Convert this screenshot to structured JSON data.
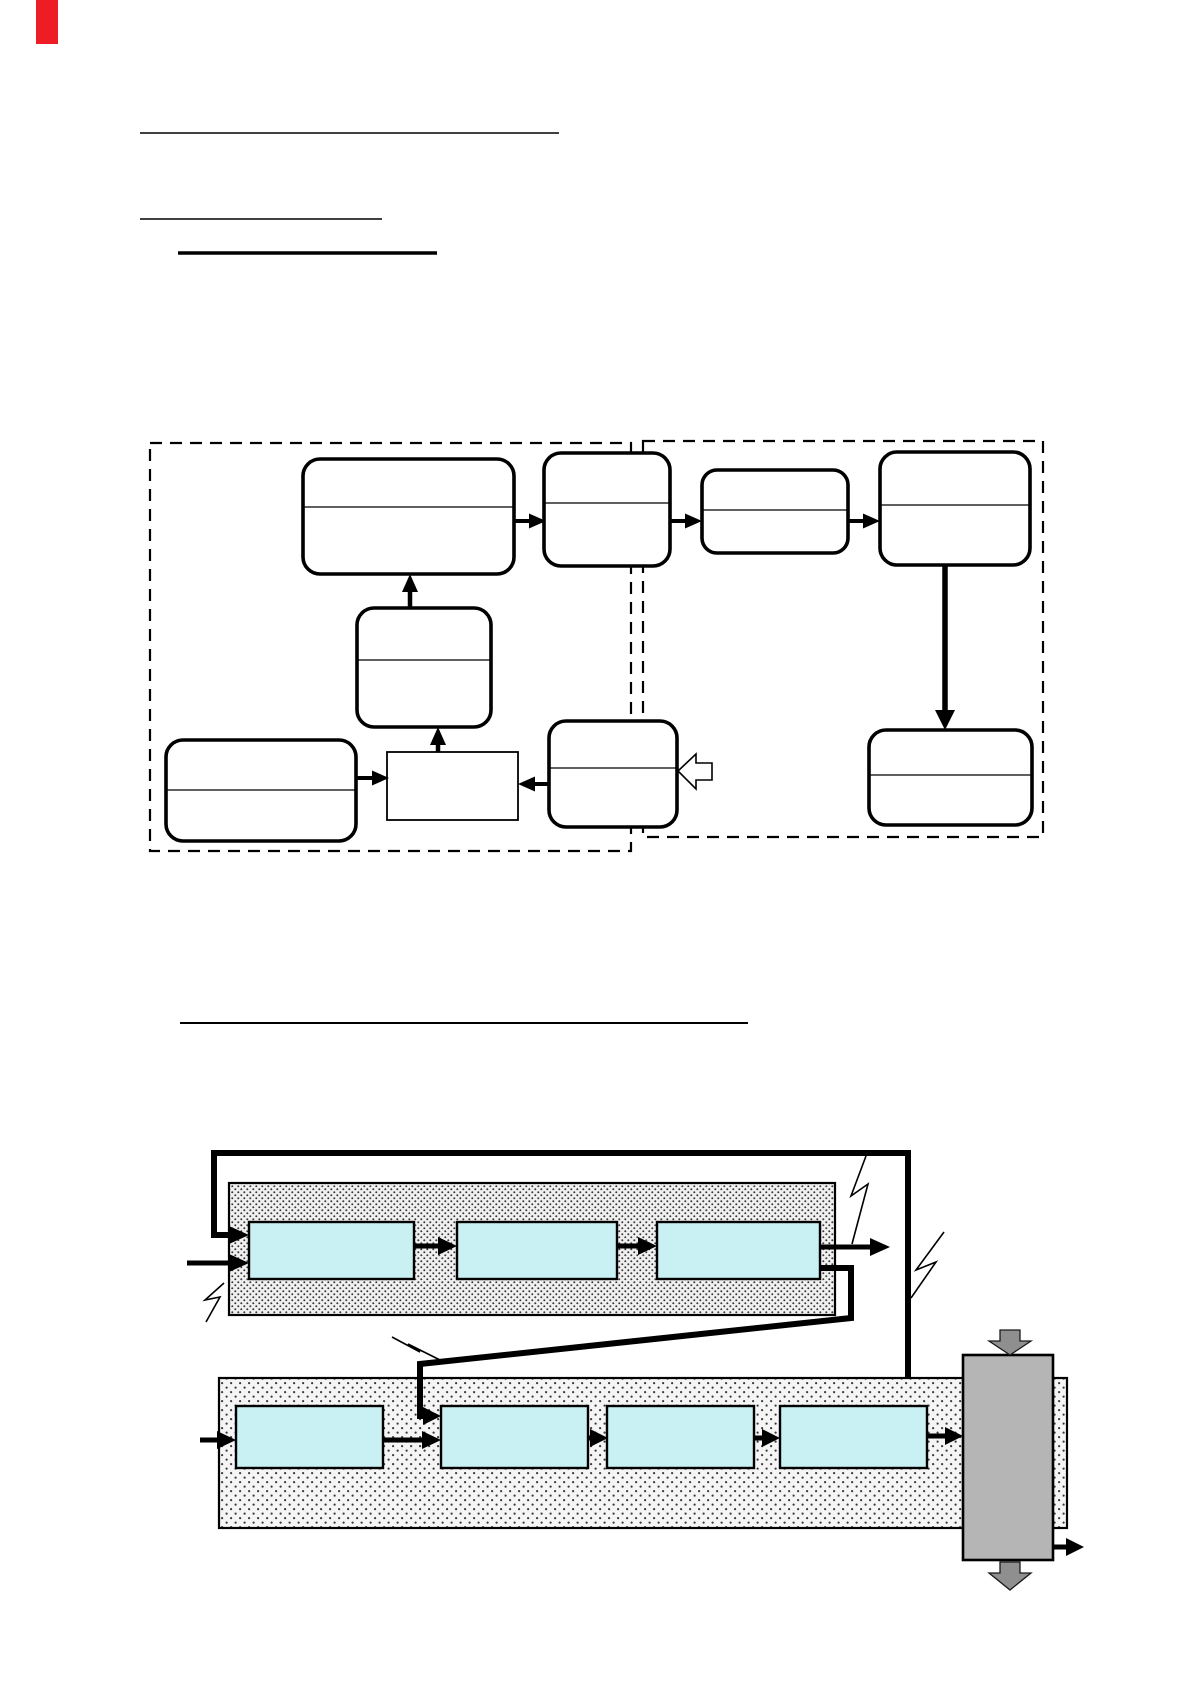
{
  "page": {
    "width": 1191,
    "height": 1684,
    "background": "#ffffff",
    "visible_text": ""
  },
  "top_left_marker": {
    "type": "red-rectangle",
    "color": "#ee1c25"
  },
  "palette": {
    "line_black": "#000000",
    "cyan_block_fill": "#c9f1f4",
    "stipple_band1_bg": "#f0f0f0",
    "stipple_band2_bg": "#f5f5f5",
    "stipple_dot": "#3a3a3a",
    "gray_slab_fill": "#b5b5b5",
    "gray_arrow_fill": "#8f8f8f",
    "box_fill": "#ffffff",
    "red_marker": "#ee1c25"
  },
  "headings": {
    "note": "three blank underlined heading rules at top, one blank underlined heading rule above lower diagram",
    "underline_count": 4
  },
  "flowchart": {
    "type": "state-flow diagram",
    "dashed_containers": 2,
    "left_container": {
      "rounded_boxes_with_divider": 4,
      "plain_rect_boxes": 1,
      "straddling_boxes": 2
    },
    "right_container": {
      "rounded_boxes_with_divider": 3
    },
    "arrows": {
      "thin_black_arrows": 7,
      "thick_vertical_arrow": 1,
      "hollow_outline_arrow_pointing_left": 1
    }
  },
  "pipeline_diagram": {
    "type": "two stippled processing chains with feedback lines",
    "upper_band": {
      "cyan_blocks": 3,
      "input_arrows": 2,
      "output_arrows": 1
    },
    "lower_band": {
      "cyan_blocks": 4,
      "input_arrows": 2,
      "output_arrows": 1
    },
    "feedback_paths": 2,
    "lightning_bolts": 4,
    "gray_slab": {
      "fill": "#b5b5b5",
      "fat_gray_arrows": 2
    },
    "final_output_arrow": 1
  }
}
